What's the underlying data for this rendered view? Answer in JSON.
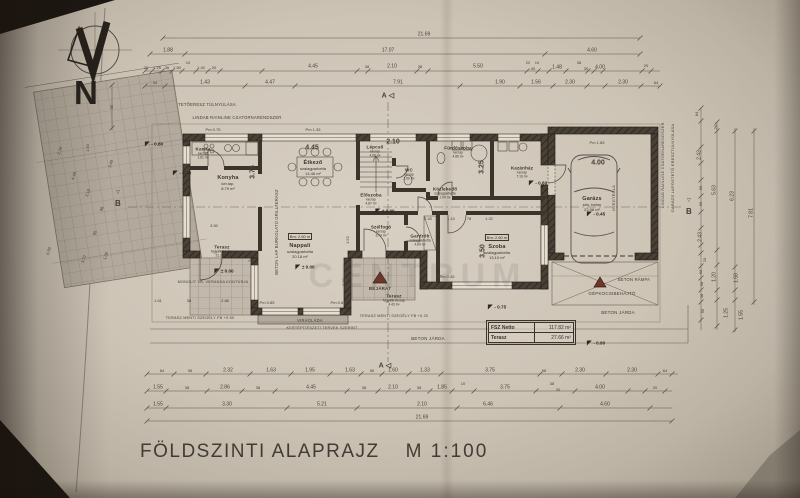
{
  "meta": {
    "title": "FÖLDSZINTI ALAPRAJZ",
    "scale": "M 1:100",
    "north_letter": "N"
  },
  "summary": {
    "row1_label": "FSZ Netto",
    "row1_value": "117.82 m²",
    "row2_label": "Terasz",
    "row2_value": "27.66 m²"
  },
  "colors": {
    "paper": "#cdc4b6",
    "ink": "#3b352c",
    "wall": "#3a342c",
    "tile": "#b3aa9d",
    "accent_red": "#6f3527"
  },
  "rooms": [
    {
      "id": "kamra",
      "name": "Kamra",
      "mat": "ker.lap",
      "area": "1.81 m²",
      "x": 203,
      "y": 153,
      "small": true
    },
    {
      "id": "konyha",
      "name": "Konyha",
      "mat": "ker.lap.",
      "area": "8.79 m²",
      "x": 228,
      "y": 183
    },
    {
      "id": "etkezo",
      "name": "Étkező",
      "mat": "szalagparketta",
      "area": "14.46 m²",
      "x": 313,
      "y": 168
    },
    {
      "id": "lepcso",
      "name": "Lépcső",
      "mat": "ker.lap",
      "area": "4.06 m²",
      "x": 375,
      "y": 151,
      "small": true
    },
    {
      "id": "wc",
      "name": "WC",
      "mat": "ker.lap",
      "area": "1.50 m²",
      "x": 409,
      "y": 174,
      "small": true
    },
    {
      "id": "furdoszoba",
      "name": "Fürdőszoba",
      "mat": "ker.lap",
      "area": "4.86 m²",
      "x": 458,
      "y": 152,
      "small": true
    },
    {
      "id": "kozlekedo",
      "name": "Közlekedő",
      "mat": "szalagparketta",
      "area": "2.94 m²",
      "x": 445,
      "y": 193,
      "small": true
    },
    {
      "id": "eloszoba",
      "name": "Előszoba",
      "mat": "ker.lap",
      "area": "4.87 m²",
      "x": 371,
      "y": 199,
      "small": true
    },
    {
      "id": "szelfogo",
      "name": "Szélfogó",
      "mat": "ker.lap",
      "area": "3.74 m²",
      "x": 381,
      "y": 231,
      "small": true
    },
    {
      "id": "gardrob",
      "name": "Gardrób",
      "mat": "szalagparketta",
      "area": "4.84 m²",
      "x": 420,
      "y": 240,
      "small": true
    },
    {
      "id": "szoba",
      "bm": "Bm: 2.60 m",
      "name": "Szoba",
      "mat": "szalagparketta",
      "area": "13.10 m²",
      "x": 497,
      "y": 243
    },
    {
      "id": "nappali",
      "bm": "Bm: 2.60 m",
      "name": "Nappali",
      "mat": "szalagparketta",
      "area": "20.18 m²",
      "x": 300,
      "y": 242
    },
    {
      "id": "kazanhaz",
      "name": "Kazánház",
      "mat": "ker.lap",
      "area": "7.16 m²",
      "x": 522,
      "y": 172,
      "small": true
    },
    {
      "id": "garazs",
      "name": "Garázs",
      "mat": "sim. beton",
      "area": "22.98 m²",
      "x": 592,
      "y": 204
    },
    {
      "id": "terasz-nyugati",
      "name": "Terasz",
      "mat": "fagyálló ker.lap",
      "area": "21.28 m²",
      "x": 222,
      "y": 251,
      "small": true
    },
    {
      "id": "terasz-deli",
      "name": "Terasz",
      "mat": "fagyálló ker.lap",
      "area": "4.43 m²",
      "x": 394,
      "y": 300,
      "small": true
    }
  ],
  "levels": [
    {
      "t": "± 0.00",
      "x": 305,
      "y": 267
    },
    {
      "t": "± 0.00",
      "x": 224,
      "y": 271
    },
    {
      "t": "± 0.00",
      "x": 385,
      "y": 211
    },
    {
      "t": "- 0.60",
      "x": 538,
      "y": 183
    },
    {
      "t": "- 0.45",
      "x": 596,
      "y": 214
    },
    {
      "t": "- 0.75",
      "x": 497,
      "y": 307
    },
    {
      "t": "- 0.90",
      "x": 596,
      "y": 343
    },
    {
      "t": "- 0.80",
      "x": 154,
      "y": 144
    },
    {
      "t": "- 0.70",
      "x": 182,
      "y": 173
    }
  ],
  "dims": [
    {
      "t": "21.69",
      "x": 424,
      "y": 35
    },
    {
      "t": "1.88",
      "x": 168,
      "y": 51
    },
    {
      "t": "17.07",
      "x": 388,
      "y": 51
    },
    {
      "t": "4.60",
      "x": 592,
      "y": 51
    },
    {
      "t": "20",
      "x": 146,
      "y": 68,
      "s": 4
    },
    {
      "t": "1.25",
      "x": 157,
      "y": 68,
      "s": 4
    },
    {
      "t": "36",
      "x": 167,
      "y": 68,
      "s": 4
    },
    {
      "t": "1.50",
      "x": 177,
      "y": 68,
      "s": 4
    },
    {
      "t": "10",
      "x": 188,
      "y": 63,
      "s": 4
    },
    {
      "t": "1.40",
      "x": 201,
      "y": 68,
      "s": 4
    },
    {
      "t": "20",
      "x": 214,
      "y": 68,
      "s": 4
    },
    {
      "t": "4.45",
      "x": 313,
      "y": 67
    },
    {
      "t": "38",
      "x": 367,
      "y": 67,
      "s": 4
    },
    {
      "t": "2.10",
      "x": 392,
      "y": 67
    },
    {
      "t": "38",
      "x": 420,
      "y": 67,
      "s": 4
    },
    {
      "t": "5.50",
      "x": 478,
      "y": 67
    },
    {
      "t": "22",
      "x": 528,
      "y": 63,
      "s": 4
    },
    {
      "t": "10",
      "x": 537,
      "y": 63,
      "s": 4
    },
    {
      "t": "40",
      "x": 533,
      "y": 69,
      "s": 4
    },
    {
      "t": "1.48",
      "x": 557,
      "y": 68
    },
    {
      "t": "38",
      "x": 579,
      "y": 63,
      "s": 4
    },
    {
      "t": "30",
      "x": 586,
      "y": 69,
      "s": 4
    },
    {
      "t": "4.00",
      "x": 600,
      "y": 68
    },
    {
      "t": "20",
      "x": 646,
      "y": 66,
      "s": 4
    },
    {
      "t": "94",
      "x": 155,
      "y": 83,
      "s": 4
    },
    {
      "t": "1.43",
      "x": 205,
      "y": 83
    },
    {
      "t": "4.47",
      "x": 270,
      "y": 83
    },
    {
      "t": "7.91",
      "x": 398,
      "y": 83
    },
    {
      "t": "1.90",
      "x": 500,
      "y": 83
    },
    {
      "t": "1.56",
      "x": 536,
      "y": 83
    },
    {
      "t": "2.30",
      "x": 570,
      "y": 83
    },
    {
      "t": "2.30",
      "x": 623,
      "y": 83
    },
    {
      "t": "64",
      "x": 656,
      "y": 83,
      "s": 4
    },
    {
      "t": "64",
      "x": 162,
      "y": 371,
      "s": 4
    },
    {
      "t": "98",
      "x": 190,
      "y": 371,
      "s": 4
    },
    {
      "t": "2.32",
      "x": 228,
      "y": 371
    },
    {
      "t": "1.63",
      "x": 271,
      "y": 371
    },
    {
      "t": "1.95",
      "x": 310,
      "y": 371
    },
    {
      "t": "1.63",
      "x": 350,
      "y": 371
    },
    {
      "t": "50",
      "x": 372,
      "y": 371,
      "s": 4
    },
    {
      "t": "1.60",
      "x": 393,
      "y": 371
    },
    {
      "t": "1.33",
      "x": 425,
      "y": 371
    },
    {
      "t": "3.75",
      "x": 490,
      "y": 371
    },
    {
      "t": "98",
      "x": 544,
      "y": 371,
      "s": 4
    },
    {
      "t": "2.30",
      "x": 580,
      "y": 371
    },
    {
      "t": "2.30",
      "x": 632,
      "y": 371
    },
    {
      "t": "64",
      "x": 665,
      "y": 371,
      "s": 4
    },
    {
      "t": "1.55",
      "x": 158,
      "y": 388
    },
    {
      "t": "38",
      "x": 187,
      "y": 388,
      "s": 4
    },
    {
      "t": "2.86",
      "x": 225,
      "y": 388
    },
    {
      "t": "38",
      "x": 258,
      "y": 388,
      "s": 4
    },
    {
      "t": "4.45",
      "x": 311,
      "y": 388
    },
    {
      "t": "38",
      "x": 364,
      "y": 388,
      "s": 4
    },
    {
      "t": "2.10",
      "x": 393,
      "y": 388
    },
    {
      "t": "38",
      "x": 419,
      "y": 388,
      "s": 4
    },
    {
      "t": "1.85",
      "x": 442,
      "y": 388
    },
    {
      "t": "10",
      "x": 463,
      "y": 384,
      "s": 4
    },
    {
      "t": "3.75",
      "x": 505,
      "y": 388
    },
    {
      "t": "38",
      "x": 552,
      "y": 384,
      "s": 4
    },
    {
      "t": "30",
      "x": 558,
      "y": 390,
      "s": 4
    },
    {
      "t": "4.00",
      "x": 600,
      "y": 388
    },
    {
      "t": "20",
      "x": 655,
      "y": 388,
      "s": 4
    },
    {
      "t": "1.55",
      "x": 158,
      "y": 405
    },
    {
      "t": "3.30",
      "x": 227,
      "y": 405
    },
    {
      "t": "5.21",
      "x": 322,
      "y": 405
    },
    {
      "t": "2.10",
      "x": 422,
      "y": 405
    },
    {
      "t": "6.46",
      "x": 488,
      "y": 405
    },
    {
      "t": "4.60",
      "x": 605,
      "y": 405
    },
    {
      "t": "21.69",
      "x": 422,
      "y": 418
    },
    {
      "t": "84",
      "x": 697,
      "y": 114,
      "s": 4,
      "r": -90
    },
    {
      "t": "20",
      "x": 716,
      "y": 127,
      "s": 4,
      "r": -90
    },
    {
      "t": "2.43",
      "x": 700,
      "y": 155,
      "r": -90
    },
    {
      "t": "69",
      "x": 701,
      "y": 188,
      "s": 4,
      "r": -90
    },
    {
      "t": "69",
      "x": 701,
      "y": 204,
      "s": 4,
      "r": -90
    },
    {
      "t": "5.63",
      "x": 715,
      "y": 190,
      "r": -90
    },
    {
      "t": "6.23",
      "x": 733,
      "y": 196,
      "r": -90
    },
    {
      "t": "7.81",
      "x": 752,
      "y": 213,
      "r": -90
    },
    {
      "t": "2.43",
      "x": 701,
      "y": 237,
      "r": -90
    },
    {
      "t": "20",
      "x": 705,
      "y": 260,
      "s": 4,
      "r": -90
    },
    {
      "t": "60",
      "x": 701,
      "y": 272,
      "s": 4,
      "r": -90
    },
    {
      "t": "98",
      "x": 702,
      "y": 284,
      "s": 4,
      "r": -90
    },
    {
      "t": "1.20",
      "x": 715,
      "y": 277,
      "r": -90
    },
    {
      "t": "1.58",
      "x": 737,
      "y": 278,
      "r": -90
    },
    {
      "t": "38",
      "x": 702,
      "y": 296,
      "s": 4,
      "r": -90
    },
    {
      "t": "95",
      "x": 703,
      "y": 311,
      "s": 4,
      "r": -90
    },
    {
      "t": "1.25",
      "x": 727,
      "y": 313,
      "r": -90
    },
    {
      "t": "1.55",
      "x": 742,
      "y": 315,
      "r": -90
    },
    {
      "t": "95",
      "x": 112,
      "y": 107,
      "s": 4,
      "r": -90
    },
    {
      "t": "2.78",
      "x": 60,
      "y": 151,
      "s": 4,
      "r": -72
    },
    {
      "t": "1.50",
      "x": 88,
      "y": 148,
      "s": 4,
      "r": -90
    },
    {
      "t": "4.48",
      "x": 74,
      "y": 176,
      "s": 4,
      "r": -72
    },
    {
      "t": "3.48",
      "x": 111,
      "y": 164,
      "s": 4,
      "r": -72
    },
    {
      "t": "2.18",
      "x": 88,
      "y": 193,
      "s": 4,
      "r": -72
    },
    {
      "t": "96",
      "x": 102,
      "y": 209,
      "s": 4,
      "r": -72
    },
    {
      "t": "85",
      "x": 95,
      "y": 233,
      "s": 4,
      "r": -72
    },
    {
      "t": "1.26",
      "x": 106,
      "y": 256,
      "s": 4,
      "r": -72
    },
    {
      "t": "6.50",
      "x": 49,
      "y": 251,
      "s": 4,
      "r": -75
    },
    {
      "t": "5.72",
      "x": 84,
      "y": 259,
      "s": 4,
      "r": -72
    },
    {
      "t": "1.61",
      "x": 158,
      "y": 301,
      "s": 4
    },
    {
      "t": "38",
      "x": 189,
      "y": 301,
      "s": 4
    },
    {
      "t": "2.86",
      "x": 225,
      "y": 301,
      "s": 4
    },
    {
      "t": "2.93",
      "x": 250,
      "y": 258,
      "s": 4,
      "r": -90
    },
    {
      "t": "3.50",
      "x": 214,
      "y": 226,
      "s": 4
    },
    {
      "t": "2.40",
      "x": 428,
      "y": 219,
      "s": 4
    },
    {
      "t": "1.10",
      "x": 451,
      "y": 219,
      "s": 4
    },
    {
      "t": "78",
      "x": 469,
      "y": 219,
      "s": 4
    },
    {
      "t": "1.32",
      "x": 489,
      "y": 219,
      "s": 4
    },
    {
      "t": "1.52",
      "x": 348,
      "y": 240,
      "s": 4,
      "r": -90
    },
    {
      "t": "1.20",
      "x": 344,
      "y": 282,
      "s": 4,
      "r": -90
    },
    {
      "t": "4.45",
      "x": 312,
      "y": 148,
      "s": 7,
      "b": 1
    },
    {
      "t": "2.10",
      "x": 393,
      "y": 142,
      "s": 7,
      "b": 1
    },
    {
      "t": "3.25",
      "x": 482,
      "y": 167,
      "s": 7,
      "b": 1,
      "r": -90
    },
    {
      "t": "3.50",
      "x": 483,
      "y": 251,
      "s": 7,
      "b": 1,
      "r": -90
    },
    {
      "t": "3.75",
      "x": 253,
      "y": 172,
      "s": 7,
      "b": 1,
      "r": -90
    },
    {
      "t": "4.00",
      "x": 598,
      "y": 163,
      "s": 7,
      "b": 1
    },
    {
      "t": "Pm 0.75",
      "x": 213,
      "y": 130,
      "s": 4
    },
    {
      "t": "Pm 1.35",
      "x": 313,
      "y": 130,
      "s": 4
    },
    {
      "t": "Pm 1.85",
      "x": 597,
      "y": 143,
      "s": 4
    },
    {
      "t": "Pm 0.85",
      "x": 267,
      "y": 303,
      "s": 4
    },
    {
      "t": "Pm 0.85",
      "x": 338,
      "y": 303,
      "s": 4
    },
    {
      "t": "Pm 0.45",
      "x": 447,
      "y": 277,
      "s": 4
    }
  ],
  "annotations": [
    {
      "id": "roof-overhang-note",
      "t": "TETŐERESZ TÚLNYÚLÁSA",
      "x": 207,
      "y": 105,
      "s": 4.2
    },
    {
      "id": "gutter-note-top",
      "t": "LINDAB RAINLINE CSATORNARENDSZER",
      "x": 237,
      "y": 118,
      "s": 4.2
    },
    {
      "id": "gutter-note-right",
      "t": "LINDAB RAINLINE CSATORNARENDSZER",
      "x": 663,
      "y": 165,
      "s": 4,
      "r": -90
    },
    {
      "id": "garage-roof-note",
      "t": "GARÁZS LAPOSTETŐ ERESZTÚLNYÚLÁSA",
      "x": 673,
      "y": 168,
      "s": 4,
      "r": -90
    },
    {
      "id": "glass-brick-note",
      "t": "ÜVEGTÉGLA",
      "x": 614,
      "y": 198,
      "s": 4,
      "r": -90
    },
    {
      "id": "grill-terrace-note",
      "t": "BETON LAP BURKOLATÚ GRILLTERASZ",
      "x": 277,
      "y": 232,
      "s": 4.2,
      "r": -90
    },
    {
      "id": "entrance-label",
      "t": "BEJÁRAT",
      "x": 380,
      "y": 289,
      "s": 4.5,
      "b": 1
    },
    {
      "id": "flower-box-label",
      "t": "VIRÁGLÁDA",
      "x": 310,
      "y": 321,
      "s": 4.2
    },
    {
      "id": "garden-plan-note",
      "t": "KERTÉPÍTÉSZETI TERVEK SZERINT",
      "x": 322,
      "y": 329,
      "s": 3.8
    },
    {
      "id": "sidewalk-label-1",
      "t": "BETON JÁRDA",
      "x": 428,
      "y": 339,
      "s": 4.5
    },
    {
      "id": "sidewalk-label-2",
      "t": "BETON JÁRDA",
      "x": 618,
      "y": 313,
      "s": 4.5
    },
    {
      "id": "ramp-label",
      "t": "BETON RÁMPA",
      "x": 634,
      "y": 280,
      "s": 4.2
    },
    {
      "id": "driveway-label",
      "t": "GÉPKOCSIBEHAJTÓ",
      "x": 612,
      "y": 294,
      "s": 4.5
    },
    {
      "id": "terrace-edge-note-1",
      "t": "TERASZ MENTI SZEGÉLY FB +0.50",
      "x": 200,
      "y": 319,
      "s": 3.8
    },
    {
      "id": "terrace-edge-note-2",
      "t": "TERASZ MENTI SZEGÉLY FB +0.20",
      "x": 394,
      "y": 317,
      "s": 3.8
    },
    {
      "id": "veranda-note",
      "t": "MONOLIT VB. VERANDA KONTÚRJA",
      "x": 213,
      "y": 283,
      "s": 3.8
    },
    {
      "id": "section-a-top",
      "t": "A ◁",
      "x": 388,
      "y": 96,
      "s": 7,
      "b": 1
    },
    {
      "id": "section-a-bottom",
      "t": "A ◁",
      "x": 385,
      "y": 366,
      "s": 7,
      "b": 1
    },
    {
      "id": "section-b-left",
      "t": "▽",
      "x": 118,
      "y": 193,
      "s": 5
    },
    {
      "id": "section-b-left-letter",
      "t": "B",
      "x": 118,
      "y": 204,
      "s": 8,
      "b": 1
    },
    {
      "id": "section-b-right",
      "t": "▽",
      "x": 689,
      "y": 201,
      "s": 5
    },
    {
      "id": "section-b-right-letter",
      "t": "B",
      "x": 689,
      "y": 212,
      "s": 8,
      "b": 1
    }
  ],
  "watermark": {
    "t": "CENTRUM",
    "x": 418,
    "y": 276,
    "s": 34
  }
}
